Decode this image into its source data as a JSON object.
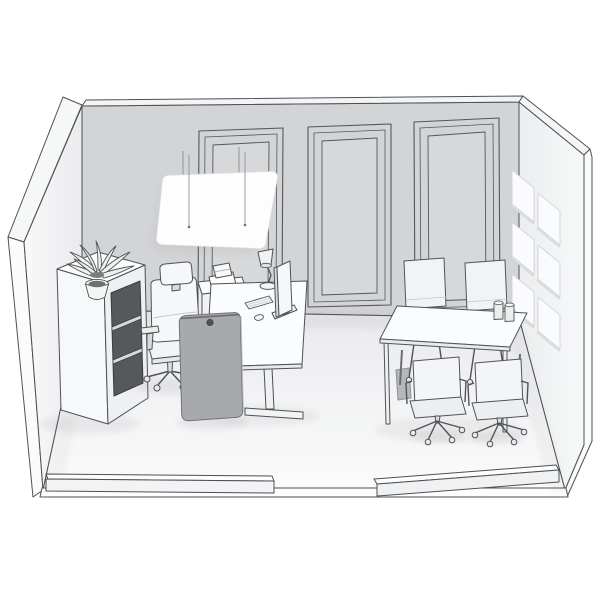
{
  "scene": {
    "title": "isometric-office-room-render",
    "background": "#ffffff",
    "colors": {
      "outline": "#4e5054",
      "back_wall": "#d3d4d6",
      "wall_top_strip": "#f3f4f5",
      "left_wall_light": "#fafafb",
      "right_wall_light": "#f6f7f9",
      "floor_back": "#e8e9eb",
      "floor_front": "#fbfbfc",
      "pendant_panel": "#fdfdfe",
      "acoustic_tile": "#fafbfc",
      "privacy_screen": "#a8a9ac",
      "screen_grommet": "#515254",
      "shelf_opening": "#57585b",
      "furniture_white": "#fbfcfd",
      "furniture_shade": "#eceef0"
    },
    "objects": [
      {
        "id": "room-shell",
        "label": "room shell with cutaway walls"
      },
      {
        "id": "back-wall-molding-panels",
        "label": "wall molding panels",
        "count": 3
      },
      {
        "id": "ceiling-acoustic-panel",
        "label": "suspended acoustic ceiling panel on wires"
      },
      {
        "id": "acoustic-wall-tiles",
        "label": "square acoustic tiles on right wall",
        "count": 6
      },
      {
        "id": "credenza",
        "label": "sideboard with open shelves"
      },
      {
        "id": "plant",
        "label": "potted plant on sideboard"
      },
      {
        "id": "side-table",
        "label": "side table with paper tray"
      },
      {
        "id": "task-chair",
        "label": "ergonomic task chair with headrest"
      },
      {
        "id": "sit-stand-desk",
        "label": "height adjustable desk"
      },
      {
        "id": "monitor",
        "label": "monitor"
      },
      {
        "id": "desk-lamp",
        "label": "articulated desk lamp"
      },
      {
        "id": "keyboard",
        "label": "keyboard"
      },
      {
        "id": "mouse",
        "label": "mouse"
      },
      {
        "id": "privacy-screen",
        "label": "freestanding gray acoustic screen"
      },
      {
        "id": "meeting-table",
        "label": "meeting table"
      },
      {
        "id": "meeting-chairs",
        "label": "meeting chairs",
        "count": 4
      },
      {
        "id": "cups",
        "label": "cups on meeting table",
        "count": 2
      },
      {
        "id": "front-knee-walls",
        "label": "sectioned front wall strips with door opening",
        "count": 2
      }
    ]
  }
}
